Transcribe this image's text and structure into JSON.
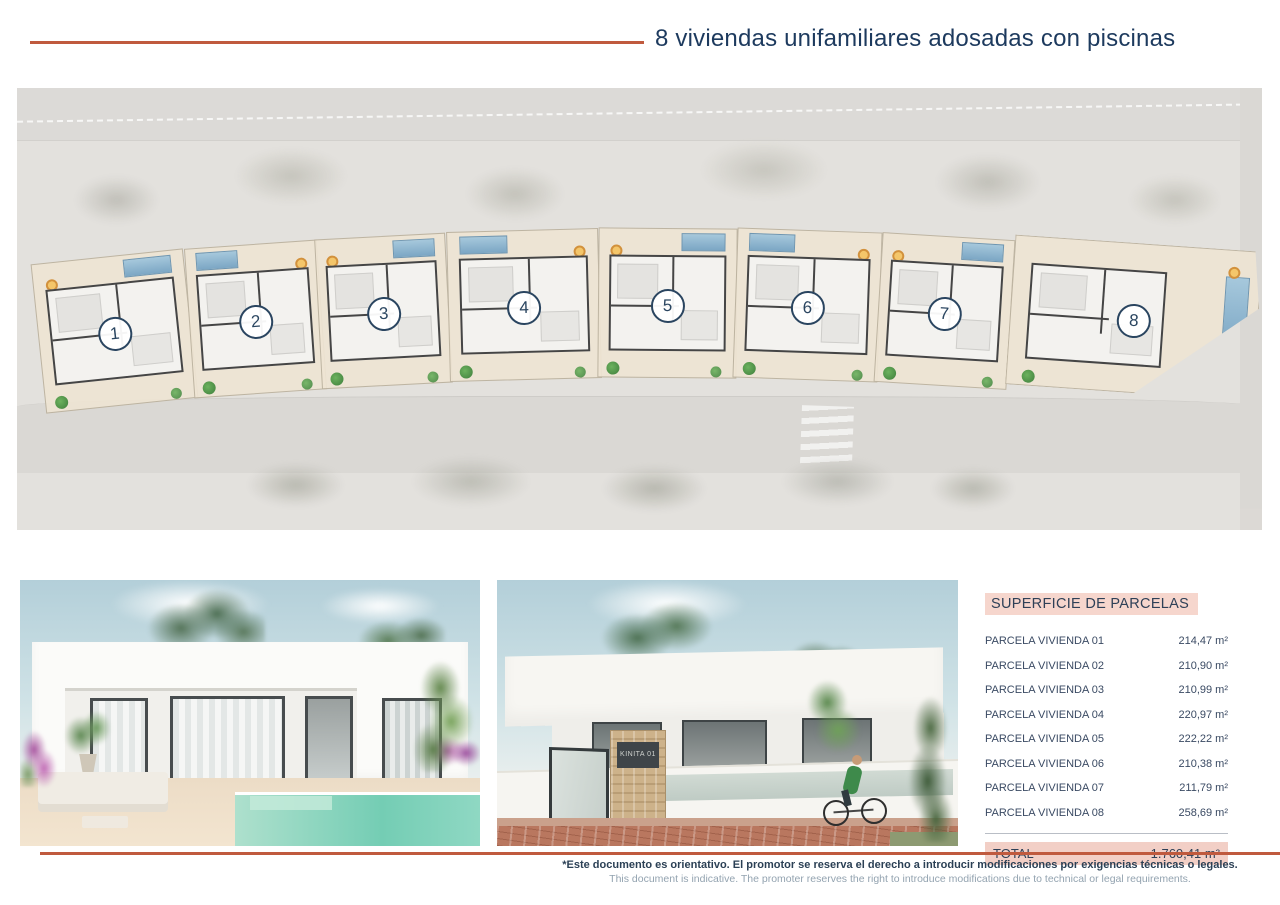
{
  "header": {
    "title": "8 viviendas unifamiliares adosadas con piscinas"
  },
  "site_plan": {
    "houses": [
      {
        "number": "1"
      },
      {
        "number": "2"
      },
      {
        "number": "3"
      },
      {
        "number": "4"
      },
      {
        "number": "5"
      },
      {
        "number": "6"
      },
      {
        "number": "7"
      },
      {
        "number": "8"
      }
    ]
  },
  "renders": {
    "street_view": {
      "sign_text": "KINITA 01"
    }
  },
  "table": {
    "title": "SUPERFICIE DE PARCELAS",
    "rows": [
      {
        "label": "PARCELA VIVIENDA 01",
        "value": "214,47 m²"
      },
      {
        "label": "PARCELA VIVIENDA 02",
        "value": "210,90 m²"
      },
      {
        "label": "PARCELA VIVIENDA 03",
        "value": "210,99 m²"
      },
      {
        "label": "PARCELA VIVIENDA 04",
        "value": "220,97 m²"
      },
      {
        "label": "PARCELA VIVIENDA 05",
        "value": "222,22 m²"
      },
      {
        "label": "PARCELA VIVIENDA 06",
        "value": "210,38 m²"
      },
      {
        "label": "PARCELA VIVIENDA 07",
        "value": "211,79 m²"
      },
      {
        "label": "PARCELA VIVIENDA 08",
        "value": "258,69 m²"
      }
    ],
    "total_label": "TOTAL",
    "total_value": "1.760,41 m²"
  },
  "footer": {
    "line1": "*Este documento es orientativo. El promotor se reserva el derecho a introducir modificaciones por exigencias técnicas o legales.",
    "line2": "This document is indicative. The promoter reserves the right to introduce modifications due to technical or legal requirements."
  },
  "colors": {
    "accent": "#c05a3e",
    "navy": "#1d3a5e",
    "pink_highlight": "#f6d6cd",
    "pool_blue": "#7ba6c4",
    "render_pool_teal": "#74cdb4"
  }
}
